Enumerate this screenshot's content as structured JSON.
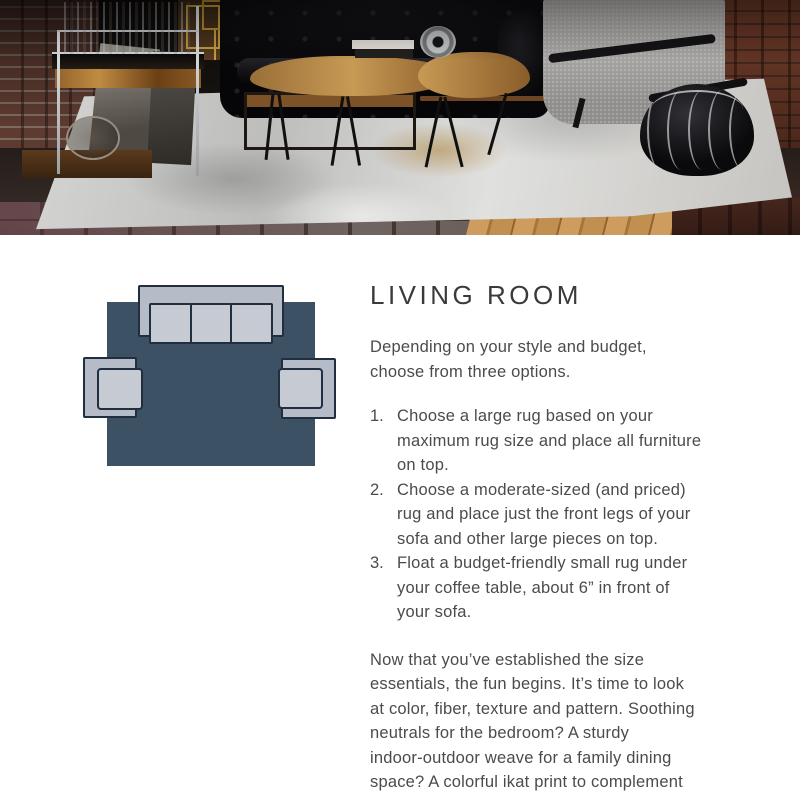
{
  "article": {
    "title": "LIVING ROOM",
    "intro": "Depending on your style and budget,\nchoose from three options.",
    "options": [
      {
        "num": "1.",
        "text": "Choose a large rug based on your\nmaximum rug size and place all furniture\non top."
      },
      {
        "num": "2.",
        "text": "Choose a moderate-sized (and priced)\nrug and place just the front legs of your\nsofa and other large pieces on top."
      },
      {
        "num": "3.",
        "text": "Float a budget-friendly small rug under\nyour coffee table, about 6” in front of\nyour sofa."
      }
    ],
    "closing": "Now that you’ve established the size\nessentials, the fun begins. It’s time to look\nat color, fiber, texture and pattern. Soothing\nneutrals for the bedroom? A sturdy\nindoor-outdoor weave for a family dining\nspace? A colorful ikat print to complement\na modern living room? Enjoy your journey"
  },
  "diagram": {
    "colors": {
      "rug": "#3c5163",
      "furniture": "#b5bbc7",
      "cushion": "#c6cad3",
      "outline": "#202e40"
    }
  },
  "theme": {
    "background": "#ffffff",
    "heading_color": "#3a3a3a",
    "body_text_color": "#4b4b4b"
  }
}
